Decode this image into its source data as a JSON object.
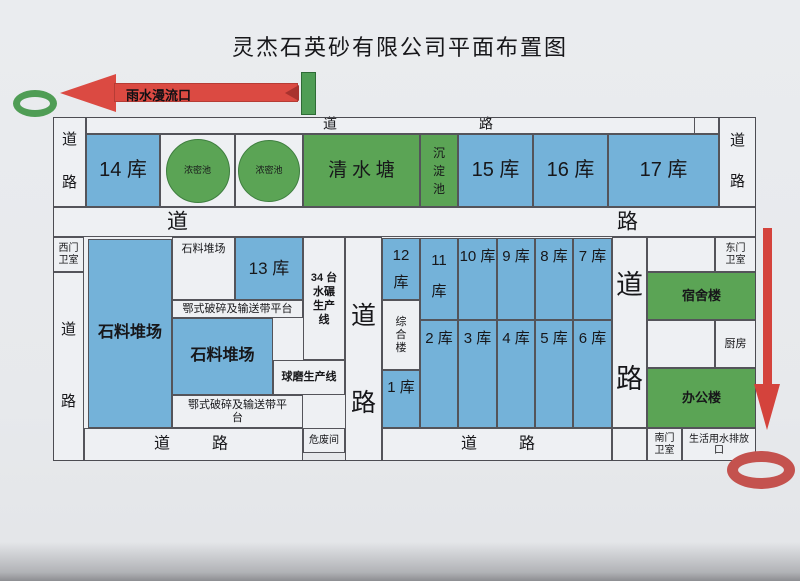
{
  "title": "灵杰石英砂有限公司平面布置图",
  "colors": {
    "warehouse_blue": "#74b2d9",
    "pond_green": "#5ba455",
    "arrow_red": "#db4a42",
    "ring_red": "#c4524e",
    "ring_green": "#4f9d55",
    "line": "#54545a",
    "paper": "#e7e9ec"
  },
  "roads": {
    "dao": "道",
    "lu": "路"
  },
  "annotations": {
    "rain_overflow_outlet": "雨水漫流口"
  },
  "top_row": {
    "warehouse_14": "14 库",
    "thickener_pond_1": "浓密池",
    "thickener_pond_2": "浓密池",
    "clear_water_pond": "清 水 塘",
    "sedimentation_pond": "沉\n淀\n池",
    "warehouse_15": "15 库",
    "warehouse_16": "16 库",
    "warehouse_17": "17 库"
  },
  "middle": {
    "west_gate_guard": "西门\n卫室",
    "stone_stockyard_large": "石料堆场",
    "stone_stockyard_small": "石料堆场",
    "warehouse_13": "13 库",
    "jaw_crusher_platform_1": "鄂式破碎及输送带平台",
    "stone_stockyard_2": "石料堆场",
    "ball_mill_line": "球磨生产线",
    "jaw_crusher_platform_2": "鄂式破碎及输送带平\n台",
    "water_mill_line": "34 台\n水碾\n生产\n线",
    "hazardous_waste_room": "危废间",
    "warehouse_12": "12\n库",
    "warehouse_11": "11\n库",
    "warehouse_10": "10 库",
    "warehouse_9": "9 库",
    "warehouse_8": "8 库",
    "warehouse_7": "7 库",
    "warehouse_1": "1 库",
    "warehouse_2": "2 库",
    "warehouse_3": "3 库",
    "warehouse_4": "4 库",
    "warehouse_5": "5 库",
    "warehouse_6": "6 库",
    "complex_building": "综\n合\n楼",
    "east_gate_guard": "东门\n卫室",
    "dormitory": "宿舍楼",
    "kitchen": "厨房",
    "office_building": "办公楼"
  },
  "bottom_row": {
    "south_gate_guard": "南门\n卫室",
    "domestic_water_outlet": "生活用水排放\n口"
  }
}
